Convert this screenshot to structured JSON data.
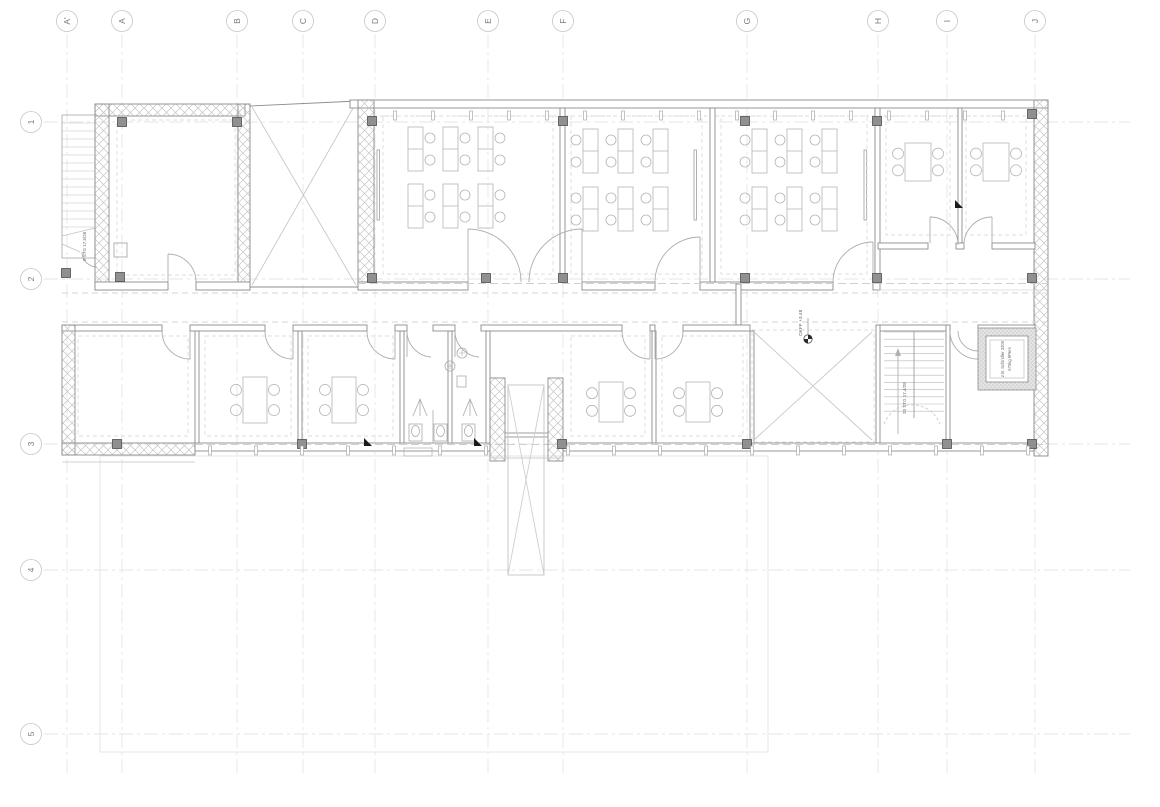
{
  "drawing": {
    "kind": "architectural-floor-plan"
  },
  "grid": {
    "columns": [
      {
        "label": "A'",
        "x": 67
      },
      {
        "label": "A",
        "x": 122
      },
      {
        "label": "B",
        "x": 237
      },
      {
        "label": "C",
        "x": 303
      },
      {
        "label": "D",
        "x": 375
      },
      {
        "label": "E",
        "x": 488
      },
      {
        "label": "F",
        "x": 563
      },
      {
        "label": "G",
        "x": 747
      },
      {
        "label": "H",
        "x": 878
      },
      {
        "label": "I",
        "x": 947
      },
      {
        "label": "J",
        "x": 1035
      }
    ],
    "rows": [
      {
        "label": "1",
        "y": 122
      },
      {
        "label": "2",
        "y": 279
      },
      {
        "label": "3",
        "y": 444
      },
      {
        "label": "4",
        "y": 570
      },
      {
        "label": "5",
        "y": 734
      }
    ]
  },
  "annotations": {
    "escape_stair": "8 STG 17,5/26",
    "main_stair": "20 STG 17,4/28",
    "level_marker": "OKFF +3.48",
    "elevator_line1": "z.B. Schindler 3300",
    "elevator_line2": "675kg 9Pers"
  },
  "furniture": {
    "classrooms": [
      {
        "name": "classroom-1",
        "deskCols": [
          408,
          443,
          478
        ],
        "deskRows": [
          127,
          184
        ],
        "chairSide": "right"
      },
      {
        "name": "classroom-2",
        "deskCols": [
          583,
          618,
          653
        ],
        "deskRows": [
          129,
          187
        ],
        "chairSide": "left"
      },
      {
        "name": "classroom-3",
        "deskCols": [
          752,
          787,
          822
        ],
        "deskRows": [
          129,
          187
        ],
        "chairSide": "left"
      }
    ],
    "meeting_tables": [
      {
        "x": 905,
        "y": 143,
        "w": 26,
        "h": 38
      },
      {
        "x": 983,
        "y": 143,
        "w": 26,
        "h": 38
      },
      {
        "x": 243,
        "y": 377,
        "w": 24,
        "h": 46
      },
      {
        "x": 332,
        "y": 377,
        "w": 24,
        "h": 46
      },
      {
        "x": 599,
        "y": 382,
        "w": 24,
        "h": 40
      },
      {
        "x": 686,
        "y": 382,
        "w": 24,
        "h": 40
      }
    ]
  },
  "colors": {
    "wall": "#8c8c8c",
    "light": "#c4c4c4",
    "furniture": "#b5b5b5",
    "grid": "#d9d9d9",
    "column_fill": "#909090",
    "text": "#6a6a6a"
  }
}
